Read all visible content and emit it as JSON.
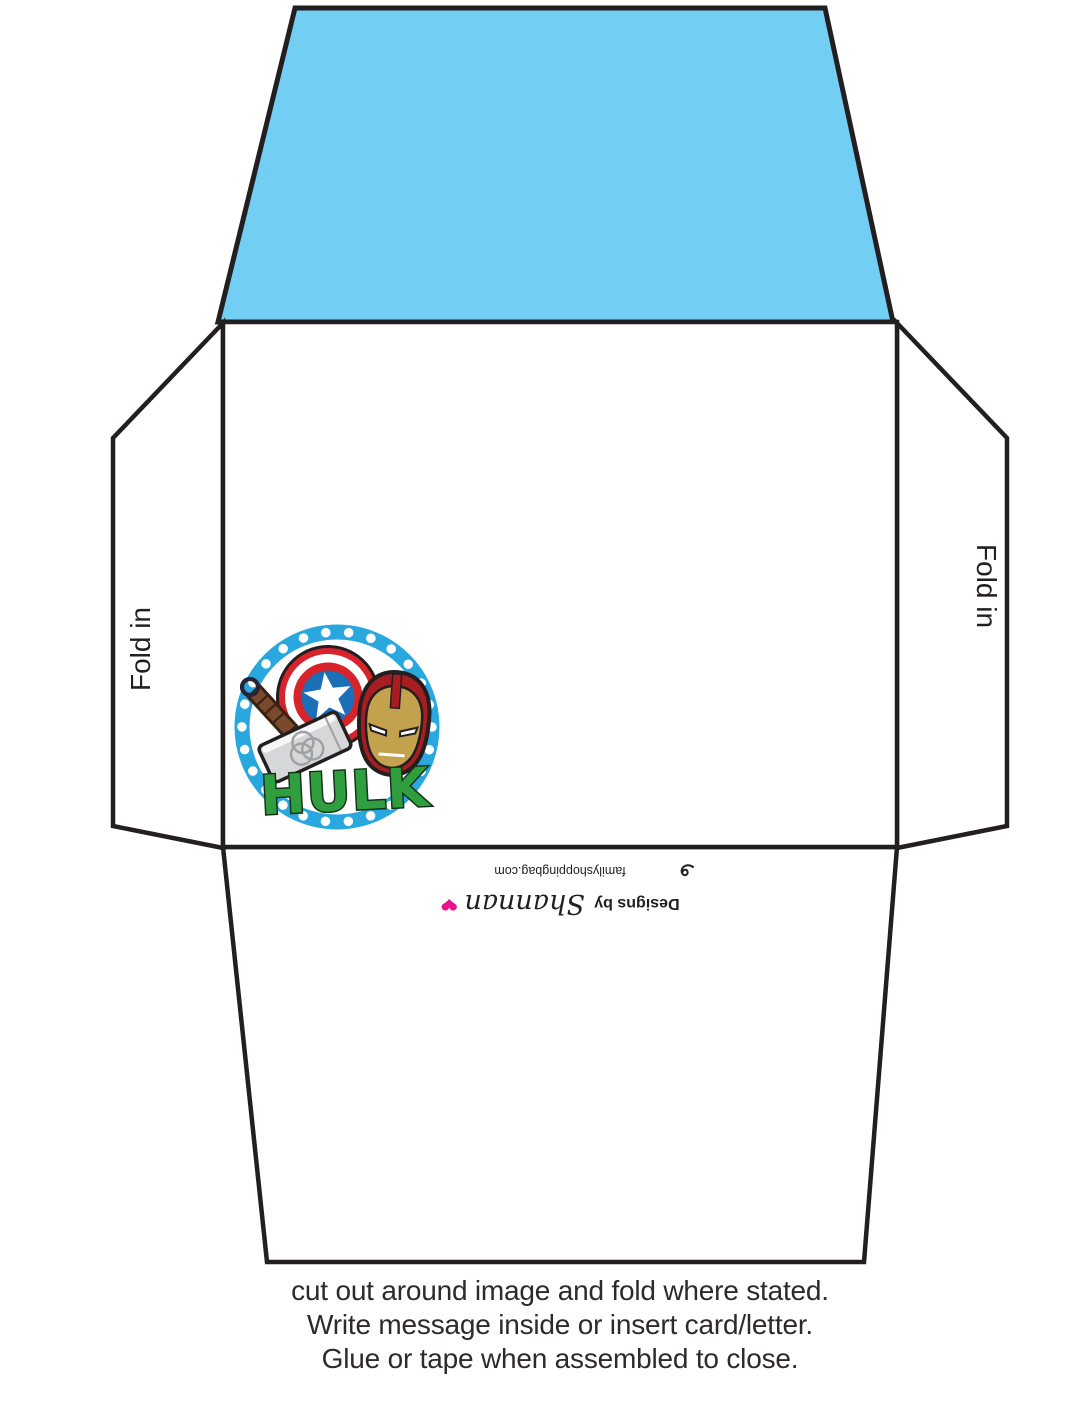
{
  "labels": {
    "fold_in_left": "Fold in",
    "fold_in_right": "Fold in"
  },
  "branding": {
    "credit_prefix": "Designs by",
    "credit_name": "Shannan",
    "heart_icon": "❤",
    "website": "familyshoppingbag.com"
  },
  "badge": {
    "hulk_text": "HULK"
  },
  "instructions": {
    "line1": "cut out around image and fold where stated.",
    "line2": "Write message inside or insert card/letter.",
    "line3": "Glue or tape when assembled to close."
  },
  "colors": {
    "flap_blue": "#73CEF4",
    "ring_blue": "#29A8E0",
    "shield_red": "#D8232A",
    "shield_blue": "#1C6EB6",
    "hammer_gray": "#D6D7D8",
    "handle_brown": "#7B4A2D",
    "ironman_red": "#A81D22",
    "ironman_gold": "#C4A24D",
    "hulk_green": "#2F9E3F",
    "heart_pink": "#E8128C",
    "outline_black": "#231F20",
    "text_dark": "#2E2A2B"
  }
}
